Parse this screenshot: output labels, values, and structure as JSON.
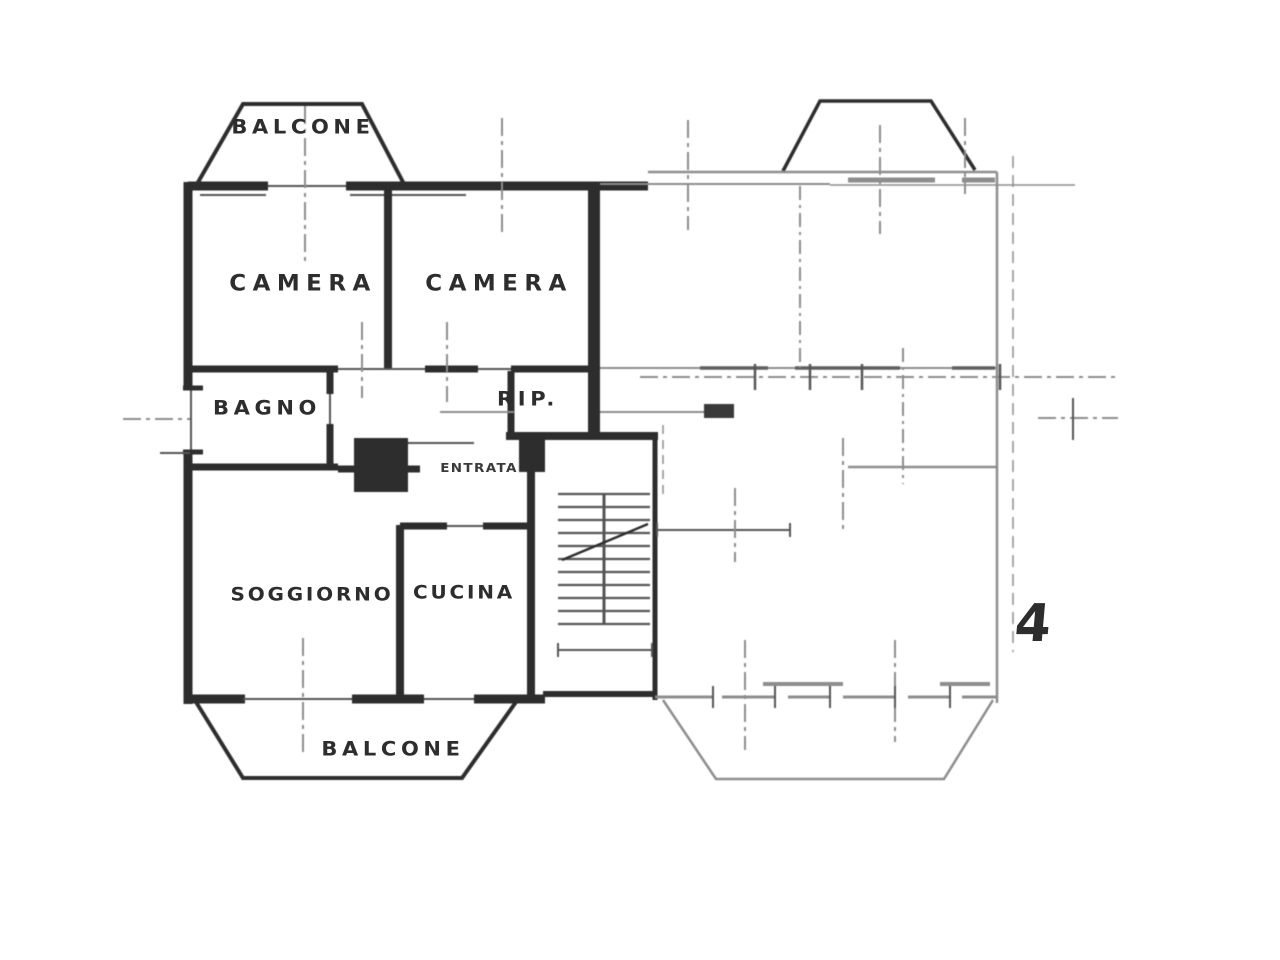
{
  "plan": {
    "labels": {
      "balcone_top": "BALCONE",
      "camera_left": "CAMERA",
      "camera_right": "CAMERA",
      "bagno": "BAGNO",
      "rip": "RIP.",
      "entrata": "ENTRATA",
      "soggiorno": "SOGGIORNO",
      "cucina": "CUCINA",
      "balcone_bottom": "BALCONE",
      "unit_number": "4"
    },
    "colors": {
      "ink": "#2d2d2d",
      "mid": "#555555",
      "faint": "#8d8d8d",
      "paper": "#ffffff"
    }
  }
}
